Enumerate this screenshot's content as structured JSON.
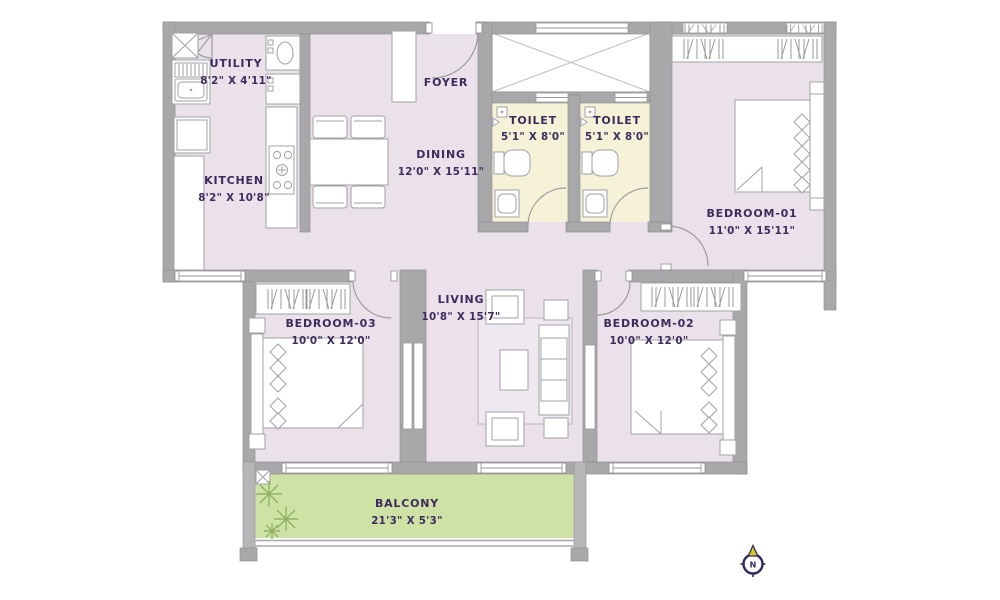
{
  "plan": {
    "rooms": [
      {
        "id": "utility",
        "name": "UTILITY",
        "dims": "8'2\" X 4'11\""
      },
      {
        "id": "kitchen",
        "name": "KITCHEN",
        "dims": "8'2\" X 10'8\""
      },
      {
        "id": "foyer",
        "name": "FOYER",
        "dims": ""
      },
      {
        "id": "dining",
        "name": "DINING",
        "dims": "12'0\" X 15'11\""
      },
      {
        "id": "toilet-1",
        "name": "TOILET",
        "dims": "5'1\" X 8'0\""
      },
      {
        "id": "toilet-2",
        "name": "TOILET",
        "dims": "5'1\" X 8'0\""
      },
      {
        "id": "bedroom-01",
        "name": "BEDROOM-01",
        "dims": "11'0\" X 15'11\""
      },
      {
        "id": "bedroom-03",
        "name": "BEDROOM-03",
        "dims": "10'0\" X 12'0\""
      },
      {
        "id": "living",
        "name": "LIVING",
        "dims": "10'8\" X 15'7\""
      },
      {
        "id": "bedroom-02",
        "name": "BEDROOM-02",
        "dims": "10'0\" X 12'0\""
      },
      {
        "id": "balcony",
        "name": "BALCONY",
        "dims": "21'3\" X 5'3\""
      }
    ],
    "compass": {
      "north_label": "N"
    },
    "colors": {
      "room_fill": "#ebe1eb",
      "toilet_fill": "#f6f2d8",
      "balcony_fill": "#cfe2a5",
      "wall": "#a8a8ab",
      "label_text": "#3e2a5c",
      "compass_ring": "#2f2b60",
      "compass_arrow": "#d9c62a",
      "plant_green": "#8fb162"
    }
  }
}
